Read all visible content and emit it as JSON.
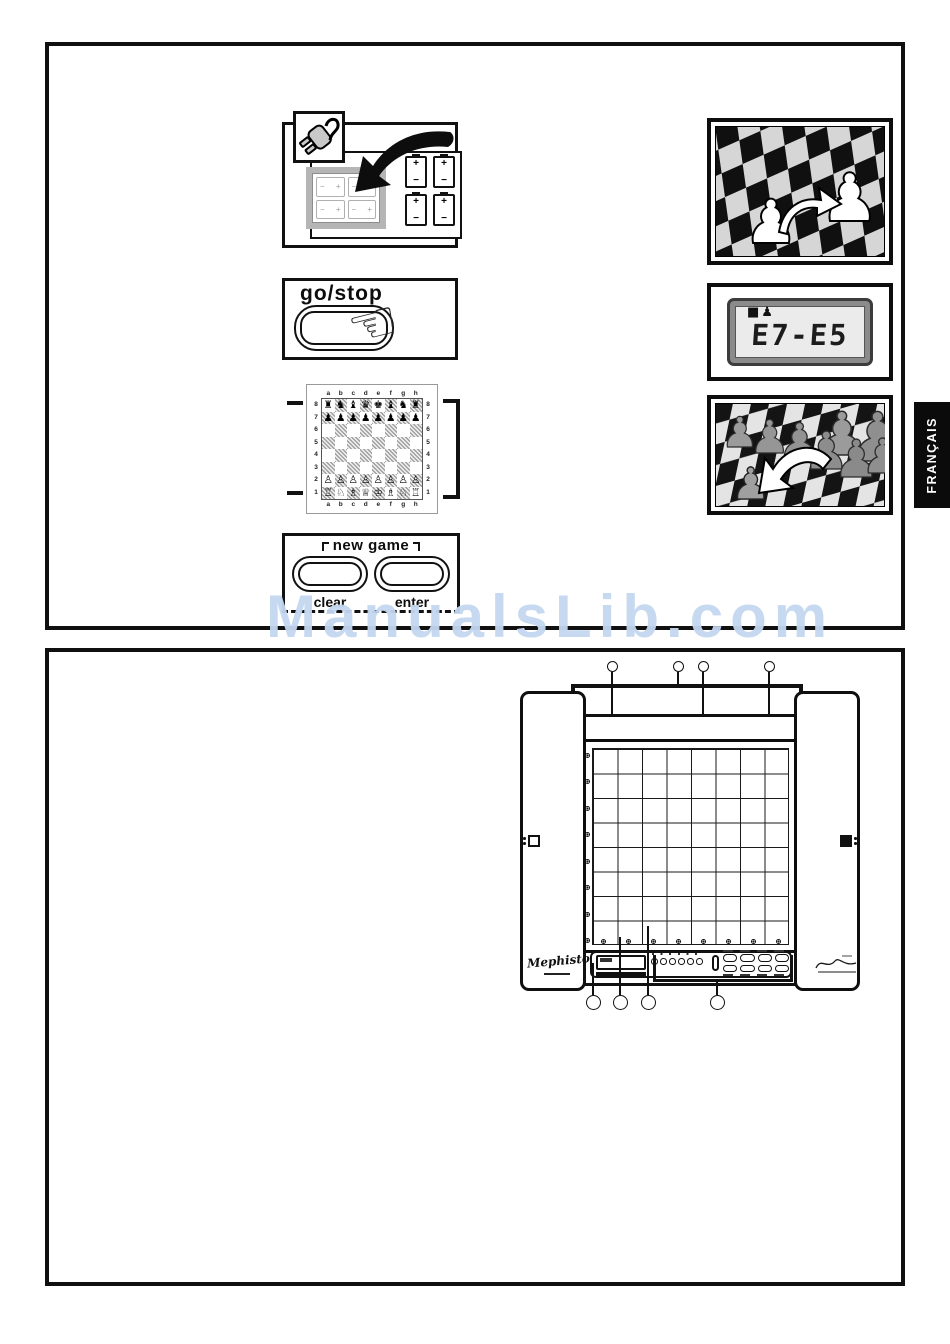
{
  "watermark": {
    "text": "ManualsLib.com",
    "color": "#c4d8f0"
  },
  "language_tab": {
    "label": "FRANÇAIS"
  },
  "figures": {
    "battery": {
      "plus": "+",
      "minus": "−",
      "cell_count": 4,
      "slot_count": 4
    },
    "go_stop": {
      "label": "go/stop"
    },
    "chessboard": {
      "files": [
        "a",
        "b",
        "c",
        "d",
        "e",
        "f",
        "g",
        "h"
      ],
      "ranks": [
        "8",
        "7",
        "6",
        "5",
        "4",
        "3",
        "2",
        "1"
      ],
      "rows": [
        [
          "♜",
          "♞",
          "♝",
          "♛",
          "♚",
          "♝",
          "♞",
          "♜"
        ],
        [
          "♟",
          "♟",
          "♟",
          "♟",
          "♟",
          "♟",
          "♟",
          "♟"
        ],
        [
          "",
          "",
          "",
          "",
          "",
          "",
          "",
          ""
        ],
        [
          "",
          "",
          "",
          "",
          "",
          "",
          "",
          ""
        ],
        [
          "",
          "",
          "",
          "",
          "",
          "",
          "",
          ""
        ],
        [
          "",
          "",
          "",
          "",
          "",
          "",
          "",
          ""
        ],
        [
          "♙",
          "♙",
          "♙",
          "♙",
          "♙",
          "♙",
          "♙",
          "♙"
        ],
        [
          "♖",
          "♘",
          "♗",
          "♕",
          "♔",
          "♗",
          "♘",
          "♖"
        ]
      ]
    },
    "new_game": {
      "title": "new game",
      "clear": "clear",
      "enter": "enter"
    },
    "lcd": {
      "display": "E7-E5",
      "icon_square": "■",
      "icon_pawn": "♟"
    }
  },
  "device": {
    "brand": "Mephisto",
    "board_grid": {
      "cols": 8,
      "rows": 8
    },
    "sensors_per_edge": 8,
    "panel": {
      "led_count": 6,
      "button_rows": 2,
      "button_cols": 4
    },
    "callouts_top": 4,
    "callouts_bottom": 4,
    "side_icons": {
      "left": "white-square-outline",
      "right": "black-square-filled"
    }
  }
}
